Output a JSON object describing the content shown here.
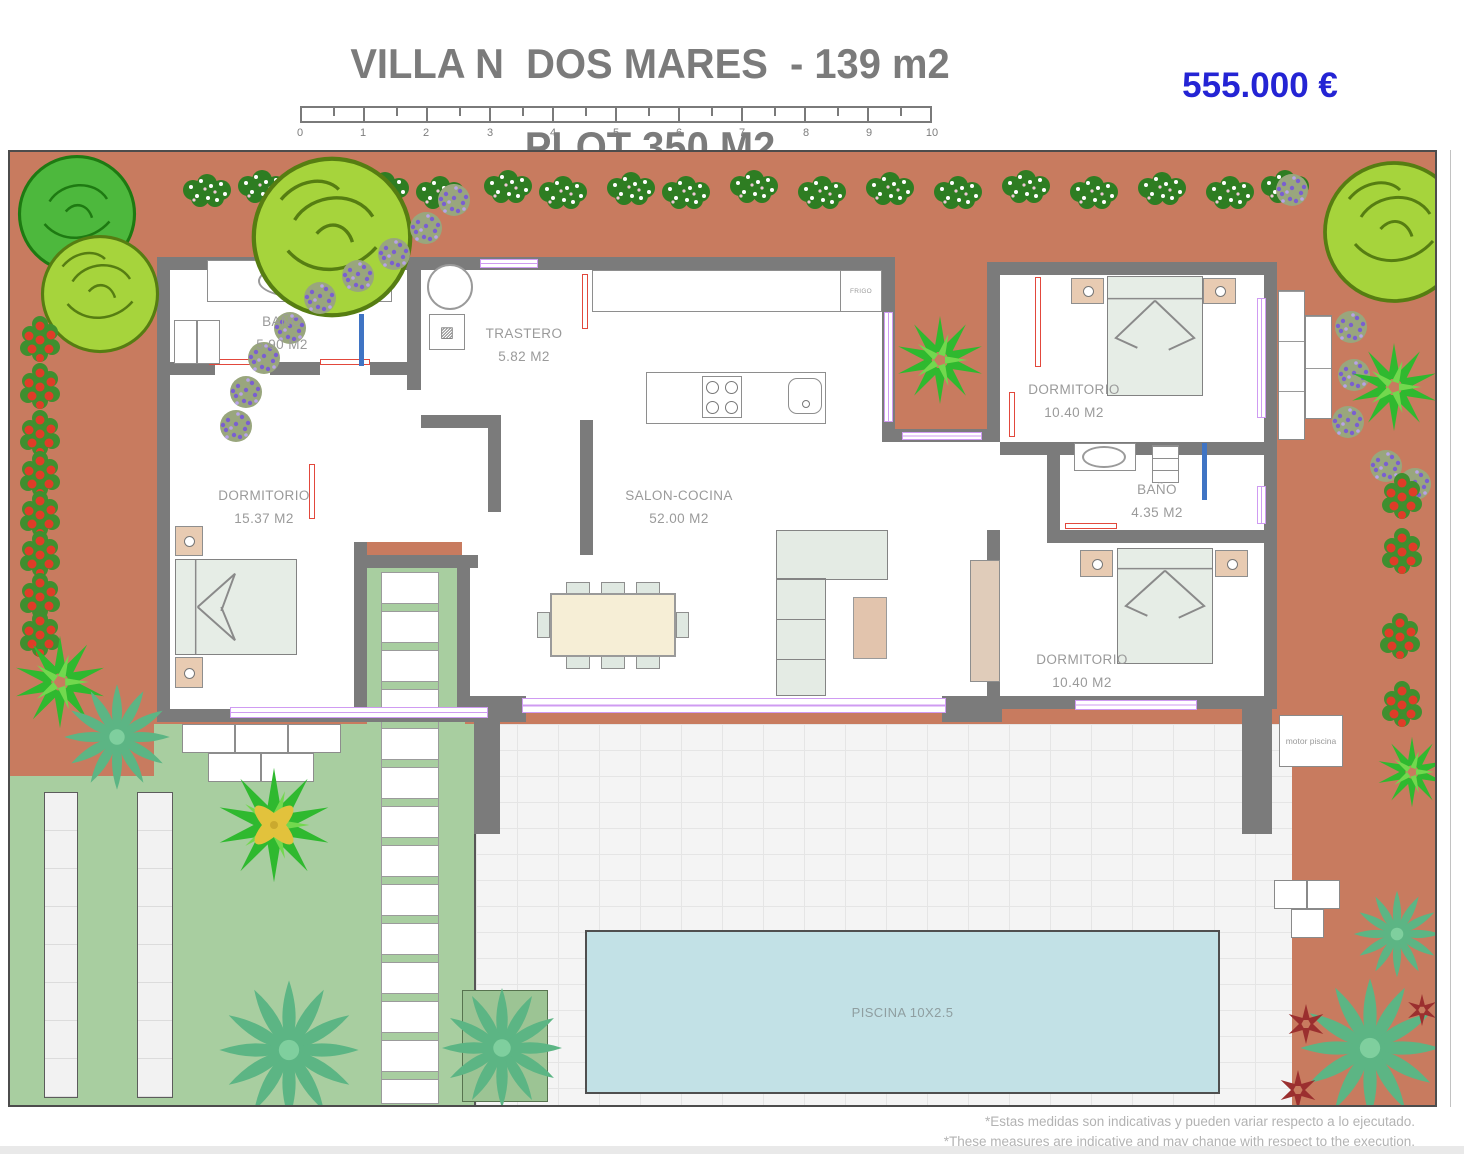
{
  "header": {
    "title_line1": "VILLA N  DOS MARES  - 139 m2",
    "title_line2": "PLOT 350 M2",
    "price": "555.000 €"
  },
  "scale_ticks": [
    "0",
    "1",
    "2",
    "3",
    "4",
    "5",
    "6",
    "7",
    "8",
    "9",
    "10"
  ],
  "rooms": {
    "bano1": {
      "name": "BAÑO",
      "area": "5.90 M2"
    },
    "trastero": {
      "name": "TRASTERO",
      "area": "5.82 M2"
    },
    "dormitorio1": {
      "name": "DORMITORIO",
      "area": "15.37 M2"
    },
    "salon": {
      "name": "SALON-COCINA",
      "area": "52.00 M2"
    },
    "dormitorio2": {
      "name": "DORMITORIO",
      "area": "10.40 M2"
    },
    "bano2": {
      "name": "BAÑO",
      "area": "4.35 M2"
    },
    "dormitorio3": {
      "name": "DORMITORIO",
      "area": "10.40 M2"
    }
  },
  "labels": {
    "frigo": "FRIGO",
    "motor_piscina": "motor piscina",
    "piscina": "PISCINA 10X2.5"
  },
  "footnotes": {
    "line1": "*Estas medidas son indicativas y pueden variar respecto a lo ejecutado.",
    "line2": "*These measures are indicative and may change with respect to the execution."
  },
  "colors": {
    "terracotta": "#c87b5f",
    "lawn": "#a8cea0",
    "pool": "#c2e1e6",
    "wall": "#7b7b7b",
    "window_frame": "#cf9bf2",
    "door": "#e2483c",
    "price_blue": "#2424d4",
    "title_gray": "#7b7b7b"
  }
}
